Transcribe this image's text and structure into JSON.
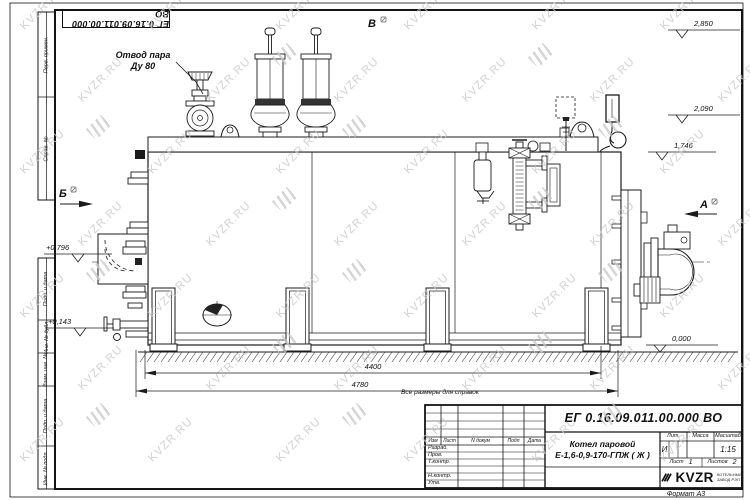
{
  "page": {
    "watermark_text": "KVZR.RU",
    "format_note": "Формат А3",
    "reference_note": "Все размеры для справок"
  },
  "frame": {
    "top_designation": "ЕГ 0.16.09.011.00.000  ВО",
    "side_labels": [
      "Перв. примен.",
      "Справ. №",
      "Подп. и дата",
      "Инв. № дубл.",
      "Взам. инв. №",
      "Подп. и дата",
      "Инв. № подл."
    ]
  },
  "drawing": {
    "callout": {
      "line1": "Отвод пара",
      "line2": "Ду 80"
    },
    "views": {
      "top": "В",
      "left": "Б",
      "right": "А"
    },
    "elevations": {
      "top": "2,850",
      "drum": "2,090",
      "shell": "1,746",
      "burner_axis": "+0,796",
      "low": "+0,143",
      "ground": "0,000"
    },
    "dimensions": {
      "supports_span": "4400",
      "overall_length": "4780"
    }
  },
  "title_block": {
    "doc_number": "ЕГ 0.16.09.011.00.000  ВО",
    "product_line1": "Котел паровой",
    "product_line2": "Е-1,6-0,9-170-ГПЖ ( Ж )",
    "rev_header": {
      "izm": "Изм",
      "list": "Лист",
      "ndoc": "N докум",
      "podp": "Подп",
      "data": "Дата"
    },
    "role_rows": [
      "Разраб.",
      "Пров.",
      "Т.контр.",
      "",
      "Н.контр.",
      "Утв."
    ],
    "lit_label": "Лит.",
    "lit_value": "И",
    "mass_label": "Масса",
    "scale_label": "Масштаб",
    "scale_value": "1:15",
    "sheet_label": "Лист",
    "sheet_value": "1",
    "sheets_label": "Листов",
    "sheets_value": "2",
    "logo_text": "KVZR",
    "logo_sub_line1": "КОТЕЛЬНЫЙ",
    "logo_sub_line2": "ЗАВОД РЭП"
  }
}
